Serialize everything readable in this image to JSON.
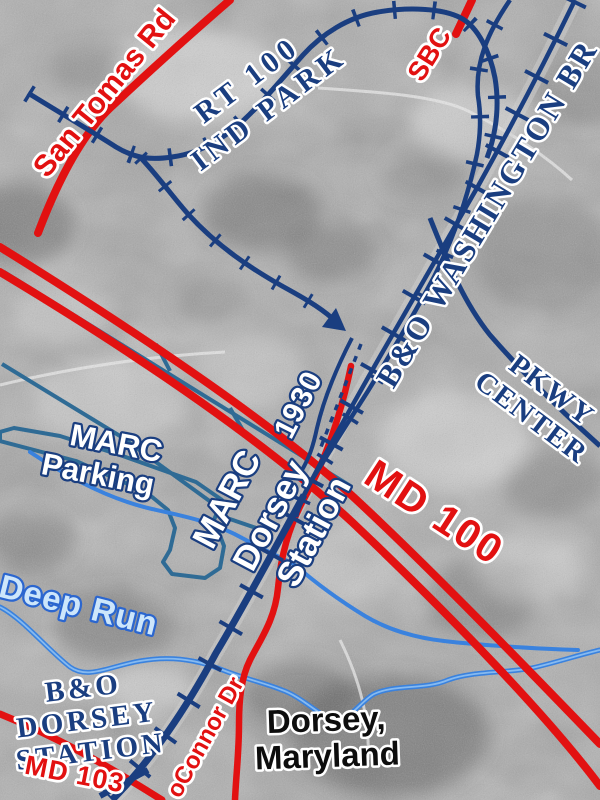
{
  "place": "Dorsey, Maryland",
  "labels": {
    "san_tomas_rd": "San Tomas Rd",
    "rt100_line1": "RT 100",
    "rt100_line2": "IND PARK",
    "sbc": "SBC",
    "bo_washington_br": "B&O WASHINGTON BR",
    "pkwy_line1": "PKWY",
    "pkwy_line2": "CENTER",
    "marc_parking_line1": "MARC",
    "marc_parking_line2": "Parking",
    "marc_station_line1": "MARC",
    "marc_station_line2": "Dorsey",
    "marc_station_line3": "Station",
    "year": "1930",
    "md100": "MD 100",
    "deep_run": "Deep Run",
    "bo_dorsey_line1": "B&O",
    "bo_dorsey_line2": "DORSEY",
    "bo_dorsey_line3": "STATION",
    "md103": "MD 103",
    "oconnor_dr": "oConnor Dr",
    "dorsey_line1": "Dorsey,",
    "dorsey_line2": "Maryland"
  },
  "colors": {
    "road_red": "#e21111",
    "rail_navy": "#1a3e80",
    "parking_outline_blue": "#2f6b95",
    "stream_blue": "#3a82de",
    "stream_label_fill": "#cde6fb",
    "photo_gray": "#ababab",
    "label_outline_white": "#ffffff"
  },
  "features": [
    {
      "name": "B&O WASHINGTON BR",
      "type": "railroad-main-line"
    },
    {
      "name": "RT 100 IND PARK",
      "type": "railroad-loop-track"
    },
    {
      "name": "PKWY CENTER",
      "type": "railroad-branch"
    },
    {
      "name": "San Tomas Rd",
      "type": "road"
    },
    {
      "name": "MD 100",
      "type": "road"
    },
    {
      "name": "MD 103",
      "type": "road"
    },
    {
      "name": "oConnor Dr",
      "type": "road"
    },
    {
      "name": "SBC",
      "type": "road-stub"
    },
    {
      "name": "Deep Run",
      "type": "stream"
    },
    {
      "name": "MARC Parking",
      "type": "parking-lot-outline"
    },
    {
      "name": "MARC Dorsey Station",
      "type": "station"
    },
    {
      "name": "B&O DORSEY STATION 1930",
      "type": "historic-station"
    }
  ]
}
